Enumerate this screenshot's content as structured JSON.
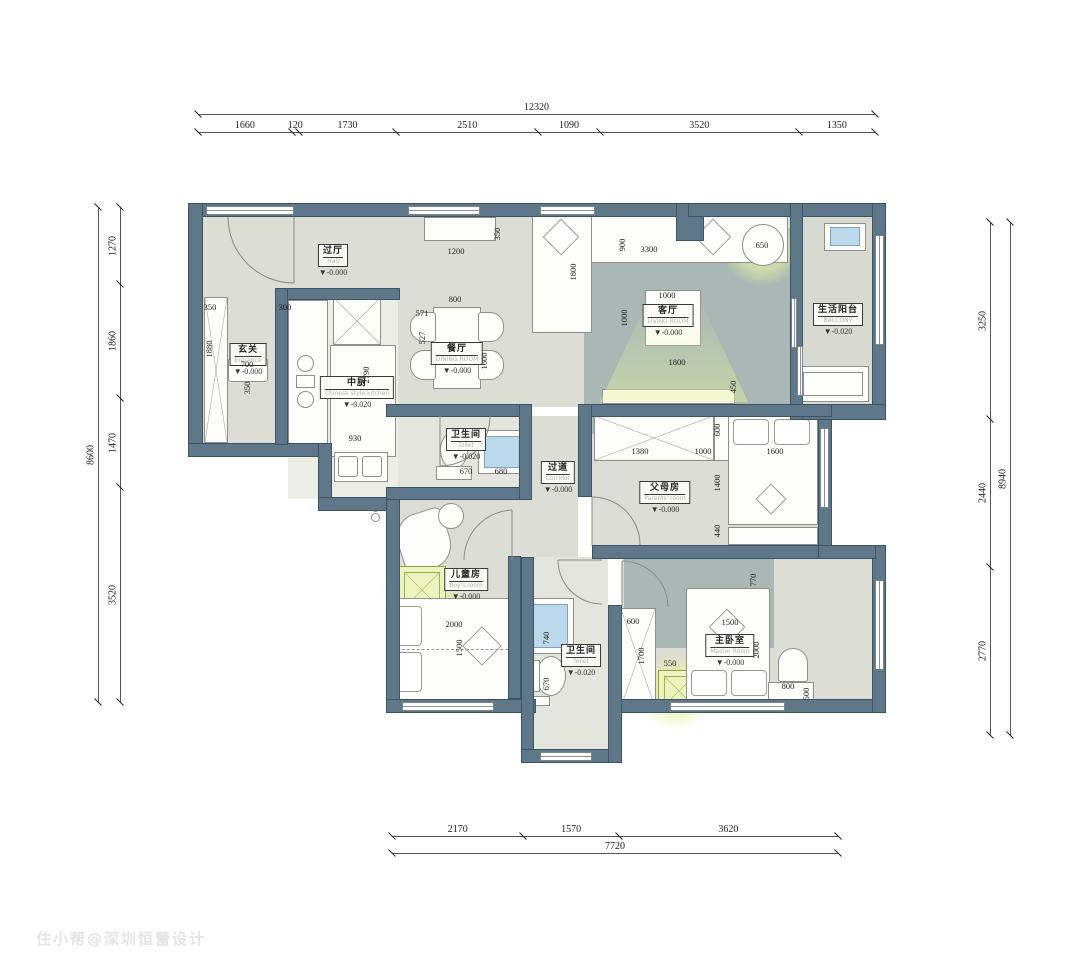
{
  "watermark": "住小帮@深圳恒蕾设计",
  "colors": {
    "wall": "#5e7889",
    "wall_edge": "#3d5363",
    "floor": "#dcddd5",
    "rug": "#a9b8b5",
    "glow": "#e9f2ac",
    "water_blue": "#bcd9ec",
    "dim_text": "#1d1d1d"
  },
  "dim_chains": {
    "top": {
      "total": "12320",
      "segments": [
        "1660",
        "120",
        "1730",
        "2510",
        "1090",
        "3520",
        "1350"
      ]
    },
    "left": {
      "total": "8600",
      "segments": [
        "1270",
        "1860",
        "1470",
        "3520"
      ]
    },
    "right": {
      "total": "8940",
      "segments": [
        "3250",
        "2440",
        "2770"
      ]
    },
    "bottom": {
      "total": "7720",
      "segments": [
        "2170",
        "1570",
        "3620"
      ]
    }
  },
  "rooms": {
    "hall": {
      "cn": "过厅",
      "en": "Hall",
      "level": "▼-0.000"
    },
    "entrance": {
      "cn": "玄关",
      "en": "Entrance",
      "level": "▼-0.000"
    },
    "kitchen": {
      "cn": "中厨",
      "en": "Chinese style kitchen",
      "level": "▼-0.020"
    },
    "dining": {
      "cn": "餐厅",
      "en": "DINING ROOM",
      "level": "▼-0.000"
    },
    "living": {
      "cn": "客厅",
      "en": "LIVING ROOM",
      "level": "▼-0.000"
    },
    "balcony": {
      "cn": "生活阳台",
      "en": "BALCONY",
      "level": "▼-0.020"
    },
    "bath1": {
      "cn": "卫生间",
      "en": "Toilet",
      "level": "▼-0.020"
    },
    "corridor": {
      "cn": "过道",
      "en": "Corridor",
      "level": "▼-0.000"
    },
    "parents": {
      "cn": "父母房",
      "en": "Parents' room",
      "level": "▼-0.000"
    },
    "kids": {
      "cn": "儿童房",
      "en": "Boy's room",
      "level": "▼-0.000"
    },
    "master": {
      "cn": "主卧室",
      "en": "Master Room",
      "level": "▼-0.000"
    },
    "bath2": {
      "cn": "卫生间",
      "en": "Toilet",
      "level": "▼-0.020"
    }
  },
  "interior_dims": [
    {
      "v": "1200"
    },
    {
      "v": "350"
    },
    {
      "v": "350"
    },
    {
      "v": "300"
    },
    {
      "v": "1880"
    },
    {
      "v": "700"
    },
    {
      "v": "350"
    },
    {
      "v": "2790"
    },
    {
      "v": "930"
    },
    {
      "v": "800"
    },
    {
      "v": "571"
    },
    {
      "v": "527"
    },
    {
      "v": "1600"
    },
    {
      "v": "1800"
    },
    {
      "v": "900"
    },
    {
      "v": "3300"
    },
    {
      "v": "1000"
    },
    {
      "v": "1000"
    },
    {
      "v": "650"
    },
    {
      "v": "1800"
    },
    {
      "v": "450"
    },
    {
      "v": "670"
    },
    {
      "v": "680"
    },
    {
      "v": "600"
    },
    {
      "v": "1380"
    },
    {
      "v": "1000"
    },
    {
      "v": "1600"
    },
    {
      "v": "1400"
    },
    {
      "v": "440"
    },
    {
      "v": "2000"
    },
    {
      "v": "1500"
    },
    {
      "v": "740"
    },
    {
      "v": "670"
    },
    {
      "v": "600"
    },
    {
      "v": "1700"
    },
    {
      "v": "550"
    },
    {
      "v": "770"
    },
    {
      "v": "1500"
    },
    {
      "v": "2000"
    },
    {
      "v": "800"
    },
    {
      "v": "500"
    }
  ]
}
